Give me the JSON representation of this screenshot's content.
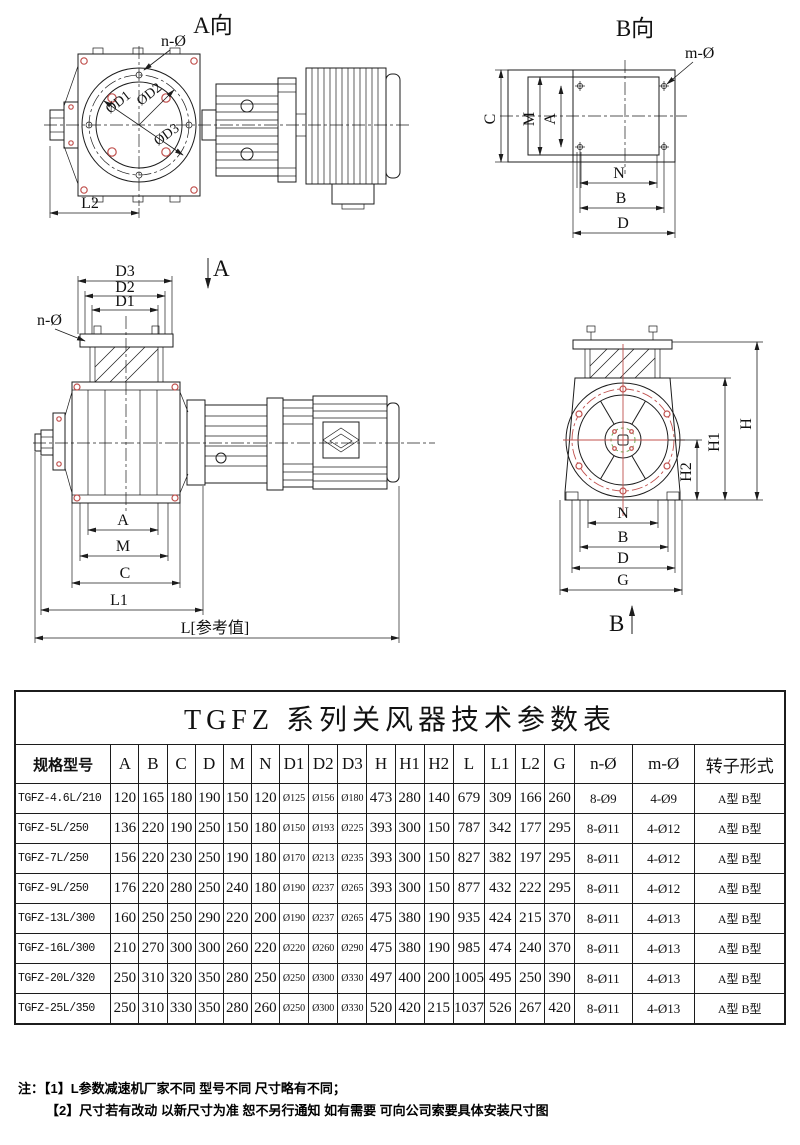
{
  "views": {
    "a": {
      "title": "A向",
      "n_label": "n-Ø",
      "d1": "ØD1",
      "d2": "ØD2",
      "d3": "ØD3",
      "l2": "L2"
    },
    "b": {
      "title": "B向",
      "m_label": "m-Ø",
      "c": "C",
      "m": "M",
      "a": "A",
      "n": "N",
      "b": "B",
      "d": "D"
    },
    "front": {
      "d3": "D3",
      "d2": "D2",
      "d1": "D1",
      "n_label": "n-Ø",
      "section": "A",
      "a": "A",
      "m": "M",
      "c": "C",
      "l1": "L1",
      "l_ref": "L[参考值]"
    },
    "side": {
      "h": "H",
      "h1": "H1",
      "h2": "H2",
      "n": "N",
      "b": "B",
      "d": "D",
      "g": "G",
      "section": "B"
    }
  },
  "table": {
    "title": "TGFZ 系列关风器技术参数表",
    "headers": [
      "规格型号",
      "A",
      "B",
      "C",
      "D",
      "M",
      "N",
      "D1",
      "D2",
      "D3",
      "H",
      "H1",
      "H2",
      "L",
      "L1",
      "L2",
      "G",
      "n-Ø",
      "m-Ø",
      "转子形式"
    ],
    "rows": [
      [
        "TGFZ-4.6L/210",
        "120",
        "165",
        "180",
        "190",
        "150",
        "120",
        "Ø125",
        "Ø156",
        "Ø180",
        "473",
        "280",
        "140",
        "679",
        "309",
        "166",
        "260",
        "8-Ø9",
        "4-Ø9",
        "A型  B型"
      ],
      [
        "TGFZ-5L/250",
        "136",
        "220",
        "190",
        "250",
        "150",
        "180",
        "Ø150",
        "Ø193",
        "Ø225",
        "393",
        "300",
        "150",
        "787",
        "342",
        "177",
        "295",
        "8-Ø11",
        "4-Ø12",
        "A型  B型"
      ],
      [
        "TGFZ-7L/250",
        "156",
        "220",
        "230",
        "250",
        "190",
        "180",
        "Ø170",
        "Ø213",
        "Ø235",
        "393",
        "300",
        "150",
        "827",
        "382",
        "197",
        "295",
        "8-Ø11",
        "4-Ø12",
        "A型  B型"
      ],
      [
        "TGFZ-9L/250",
        "176",
        "220",
        "280",
        "250",
        "240",
        "180",
        "Ø190",
        "Ø237",
        "Ø265",
        "393",
        "300",
        "150",
        "877",
        "432",
        "222",
        "295",
        "8-Ø11",
        "4-Ø12",
        "A型  B型"
      ],
      [
        "TGFZ-13L/300",
        "160",
        "250",
        "250",
        "290",
        "220",
        "200",
        "Ø190",
        "Ø237",
        "Ø265",
        "475",
        "380",
        "190",
        "935",
        "424",
        "215",
        "370",
        "8-Ø11",
        "4-Ø13",
        "A型  B型"
      ],
      [
        "TGFZ-16L/300",
        "210",
        "270",
        "300",
        "300",
        "260",
        "220",
        "Ø220",
        "Ø260",
        "Ø290",
        "475",
        "380",
        "190",
        "985",
        "474",
        "240",
        "370",
        "8-Ø11",
        "4-Ø13",
        "A型  B型"
      ],
      [
        "TGFZ-20L/320",
        "250",
        "310",
        "320",
        "350",
        "280",
        "250",
        "Ø250",
        "Ø300",
        "Ø330",
        "497",
        "400",
        "200",
        "1005",
        "495",
        "250",
        "390",
        "8-Ø11",
        "4-Ø13",
        "A型  B型"
      ],
      [
        "TGFZ-25L/350",
        "250",
        "310",
        "330",
        "350",
        "280",
        "260",
        "Ø250",
        "Ø300",
        "Ø330",
        "520",
        "420",
        "215",
        "1037",
        "526",
        "267",
        "420",
        "8-Ø11",
        "4-Ø13",
        "A型  B型"
      ]
    ]
  },
  "notes": {
    "prefix": "注：",
    "items": [
      "【1】L参数减速机厂家不同  型号不同  尺寸略有不同；",
      "【2】尺寸若有改动  以新尺寸为准  恕不另行通知  如有需要  可向公司索要具体安装尺寸图"
    ]
  },
  "colors": {
    "line": "#1c1c1c",
    "accent_red": "#c0504d",
    "accent_green": "#6aa84f"
  }
}
